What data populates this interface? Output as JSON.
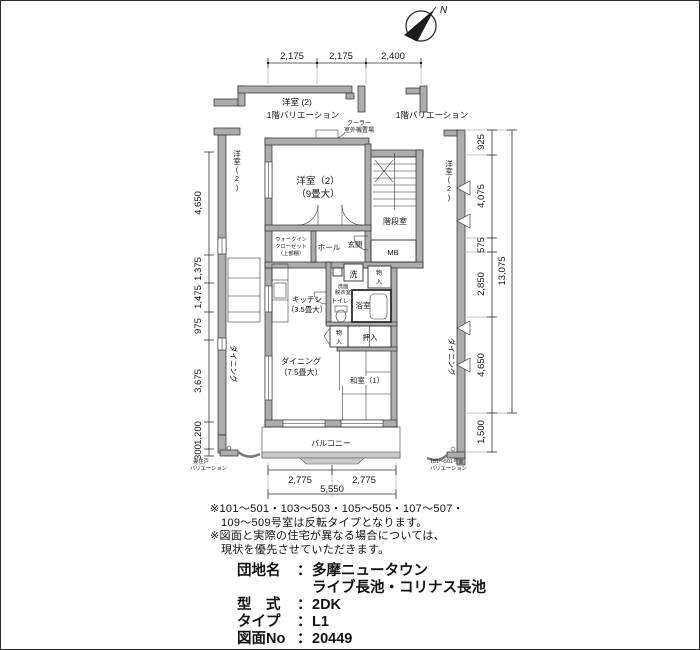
{
  "compass": {
    "label": "N"
  },
  "dimensions": {
    "top": [
      "2,175",
      "2,175",
      "2,400"
    ],
    "bottom": [
      "2,775",
      "2,775"
    ],
    "bottom_total": "5,550",
    "left": [
      "4,650",
      "1,375",
      "1,475",
      "975",
      "3,675",
      "1,200",
      "300"
    ],
    "right": [
      "925",
      "4,075",
      "575",
      "2,850",
      "4,650",
      "1,500"
    ],
    "right_total": "13,075"
  },
  "rooms": {
    "bedroom_main": [
      "洋室（2）",
      "（9畳大）"
    ],
    "stairwell": "階段室",
    "mb": "MB",
    "entrance": "玄関",
    "hall": "ホール",
    "walkin_closet": [
      "ウォークイン",
      "クローゼット",
      "（上部棚）"
    ],
    "laundry": "洗",
    "washroom": [
      "洗面",
      "脱衣室"
    ],
    "storage_upper": [
      "物",
      "入"
    ],
    "toilet": "トイレ",
    "bath": "浴室",
    "kitchen": [
      "キッチン",
      "（3.5畳大）"
    ],
    "storage_lower": [
      "物",
      "入"
    ],
    "oshiire": "押入",
    "dining": [
      "ダイニング",
      "（7.5畳大）"
    ],
    "japanese_room": "和室（1）",
    "balcony": "バルコニー"
  },
  "neighbors": {
    "left_bedroom": "洋室(2)",
    "left_dining": "ダイニング",
    "right_bedroom": "洋室(2)",
    "right_dining": "ダイニング"
  },
  "callouts": {
    "cooler": [
      "クーラー",
      "室外機置場"
    ],
    "frag_left_room": "洋室 (2)",
    "frag_left_variation": "1階バリエーション",
    "frag_right_variation": "1階バリエーション",
    "end_unit": [
      "妻住戸",
      "バリエーション"
    ],
    "right_units": [
      "101〜501号室",
      "バリエーション"
    ]
  },
  "notes": [
    "※101〜501・103〜503・105〜505・107〜507・",
    "109〜509号室は反転タイプとなります。",
    "※図面と実際の住宅が異なる場合については、",
    "現状を優先させていただきます。"
  ],
  "title_block": {
    "rows": [
      {
        "label": "団地名",
        "sep": "：",
        "value": "多摩ニュータウン"
      },
      {
        "label": "",
        "sep": "",
        "value": "ライブ長池・コリナス長池"
      },
      {
        "label": "型　式",
        "sep": "：",
        "value": "2DK"
      },
      {
        "label": "タイプ",
        "sep": "：",
        "value": "L1"
      },
      {
        "label": "図面No",
        "sep": "：",
        "value": "20449"
      }
    ]
  }
}
